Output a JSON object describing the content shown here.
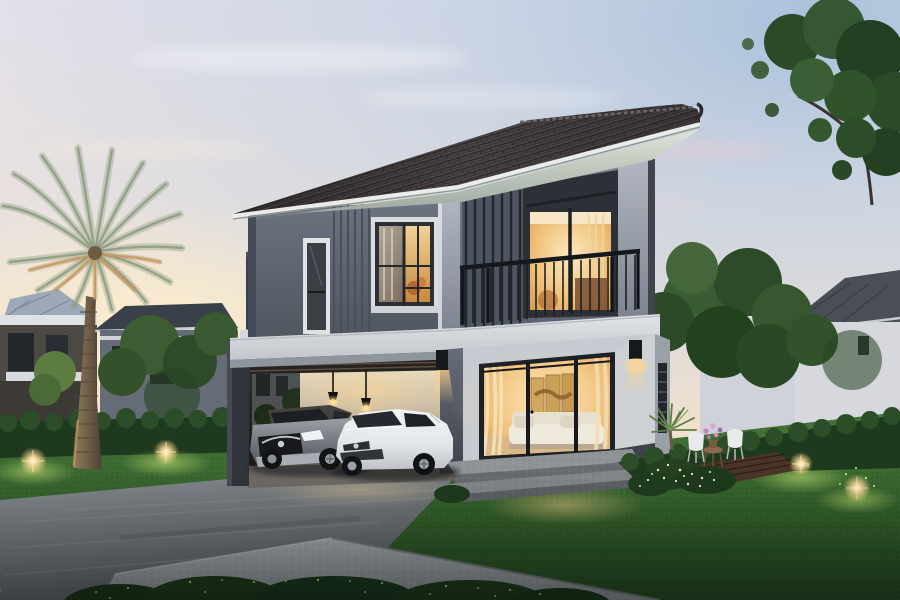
{
  "scene": {
    "description": "Photorealistic dusk rendering of a modern two-storey grey house with hip roof, upper balcony, carport with two parked cars, date palm, landscaped lawn, hedges and glowing garden lights",
    "time_of_day": "dusk",
    "style": "architectural 3D visualization",
    "weather": "clear pastel sunset sky"
  },
  "palette": {
    "sky_top": "#e4e1ea",
    "sky_mid": "#e9e1dc",
    "sky_peach": "#f4e3cc",
    "sky_horizon": "#f8ead2",
    "sky_blue": "#aac2dc",
    "roof_dark": "#3a3537",
    "fascia": "#e9ece7",
    "soffit": "#c9d2c7",
    "wall_upper": "#646b78",
    "wall_panel": "#4c525c",
    "pillar_light": "#a9aeb8",
    "band_white": "#d8dce0",
    "glass_warm": "#eec27c",
    "interior_gold": "#f7dfa8",
    "carport_wall": "#e2d5bd",
    "lawn": "#47773a",
    "lawn_dark": "#20401e",
    "hedge": "#1e3a1e",
    "tree_mid": "#35572e",
    "tree_dark": "#243f21",
    "driveway": "#787d84",
    "pad_concrete": "#9da0a6",
    "palm_frond": "#87957c",
    "palm_gold": "#b3895a",
    "trunk": "#7c6951",
    "suv_gray": "#7d8187",
    "car_white": "#e9ebee",
    "frame_dark": "#24272c",
    "railing_black": "#1d2024",
    "light_glow": "#ffdf9e",
    "deck_wood": "#4a3426"
  },
  "objects": {
    "main_house": "two-storey modern grey house with hip roof, balcony, side terrace and open carport",
    "vehicles": [
      "grey SUV parked in carport",
      "white hatchback parked in carport"
    ],
    "vegetation": [
      "tall date palm",
      "large leafy tree upper right",
      "clipped hedges",
      "lawn",
      "white-flower shrubs",
      "small fan palm"
    ],
    "lighting": [
      "4 warm garden spike lights",
      "2 black wall sconces",
      "2 carport pendant lamps",
      "warm interior lighting"
    ],
    "furniture": [
      "2 white garden chairs",
      "round wooden side table with flower pot",
      "white sofa and gold triptych painting indoors"
    ],
    "neighbor_houses": [
      "dark grey house far left",
      "grey house behind palm",
      "white house with grey roof on right"
    ]
  }
}
